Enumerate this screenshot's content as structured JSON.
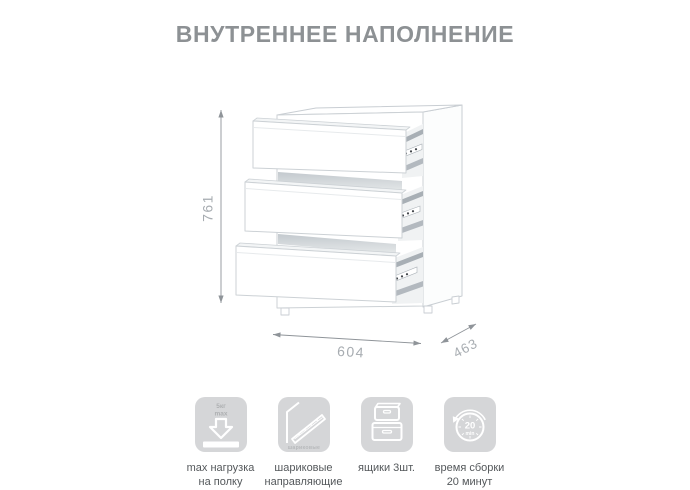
{
  "page": {
    "title": "ВНУТРЕННЕЕ НАПОЛНЕНИЕ"
  },
  "diagram": {
    "subject": "chest-of-drawers-three-drawers-open",
    "dimensions": {
      "height": "761",
      "width": "604",
      "depth": "463"
    }
  },
  "features": [
    {
      "icon": "max-load-icon",
      "icon_lines": [
        "5кг",
        "max"
      ],
      "caption_lines": [
        "max нагрузка",
        "на полку"
      ]
    },
    {
      "icon": "ball-bearing-slides-icon",
      "icon_label": "шариковые",
      "caption_lines": [
        "шариковые",
        "направляющие"
      ]
    },
    {
      "icon": "drawers-icon",
      "caption_lines": [
        "ящики 3шт.",
        ""
      ]
    },
    {
      "icon": "assembly-time-icon",
      "icon_lines": [
        "20",
        "min"
      ],
      "caption_lines": [
        "время сборки",
        "20 минут"
      ]
    }
  ],
  "colors": {
    "background": "#ffffff",
    "title": "#8d9194",
    "caption": "#54585b",
    "tile_background": "#d5d6d8",
    "dimension_line": "#8f9499",
    "dimension_label": "#a7acb1",
    "drawing_outline": "#c9ced3"
  }
}
